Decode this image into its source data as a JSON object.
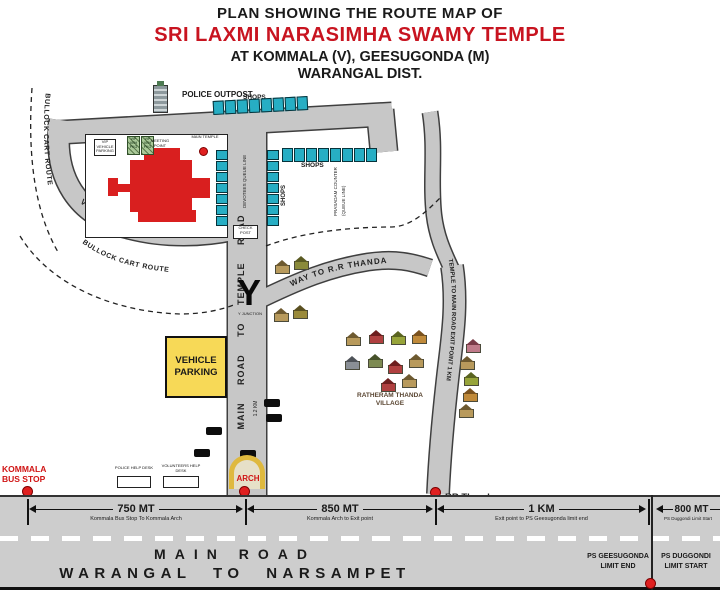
{
  "title": {
    "line1": "PLAN SHOWING THE ROUTE MAP OF",
    "line2": "SRI LAXMI NARASIMHA SWAMY TEMPLE",
    "line3": "AT KOMMALA (V), GEESUGONDA (M)",
    "line4": "WARANGAL DIST."
  },
  "map": {
    "labels": {
      "police_outpost": "POLICE OUTPOST",
      "shops_top": "SHOPS",
      "shops_mid": "SHOPS",
      "shops_col": "SHOPS",
      "bullock_left": "BULLOCK CART ROUTE",
      "bullock_inner": "BULLOCK CART ROUTE",
      "vip_route": "VIP VEHICLE ROUTE",
      "vip_parking_sign": "VIP VEHICLE PARKING",
      "vip_pkg_a": "VIP VEH PKG",
      "vip_pkg_b": "VIP VEH PKG",
      "meeting_point": "MEETING POINT",
      "main_temple": "MAIN TEMPLE",
      "queue_inner": "DEVOTEES QUEUE LINE",
      "prasadam_1": "PRASADAM COUNTER",
      "prasadam_2": "(QUEUE LINE)",
      "check_post": "CHECK POST",
      "y_junction": "Y JUNCTION",
      "way_rr": "WAY TO R.R THANDA",
      "temple_exit": "TEMPLE TO MAIN ROAD EXIT POINT 1 KM",
      "main_to_temple": "MAIN ROAD TO TEMPLE ROAD",
      "temple_road_km": "1.2 KM",
      "vehicle_parking": "VEHICLE PARKING",
      "village": "RATHERAM THANDA VILLAGE",
      "arch": "ARCH",
      "kommala": "KOMMALA BUS STOP",
      "exit_point": "EXIT POINT",
      "rr_thanda": "RR Thanda",
      "desk_a": "POLICE HELP DESK",
      "desk_b": "VOLUNTEERS HELP DESK"
    }
  },
  "bottom": {
    "segments": [
      {
        "distance": "750 MT",
        "detail": "Kommala Bus Stop To Kommala Arch"
      },
      {
        "distance": "850 MT",
        "detail": "Kommala Arch to Exit point"
      },
      {
        "distance": "1 KM",
        "detail": "Exit point to PS Geesugonda limit end"
      },
      {
        "distance": "800 MT",
        "detail": "PS Duggondi Limit Start"
      }
    ],
    "road_name_line1": "MAIN ROAD",
    "road_name_line2": "WARANGAL TO NARSAMPET",
    "ps_left_line1": "PS GEESUGONDA",
    "ps_left_line2": "LIMIT END",
    "ps_right_line1": "PS DUGGONDI",
    "ps_right_line2": "LIMIT START"
  },
  "colors": {
    "title_accent": "#c81420",
    "road_gray": "#c7c7c7",
    "shop_cyan": "#27aec4",
    "temple_red": "#d91f1f",
    "parking_yellow": "#f7d957",
    "marker_red": "#e02020"
  }
}
